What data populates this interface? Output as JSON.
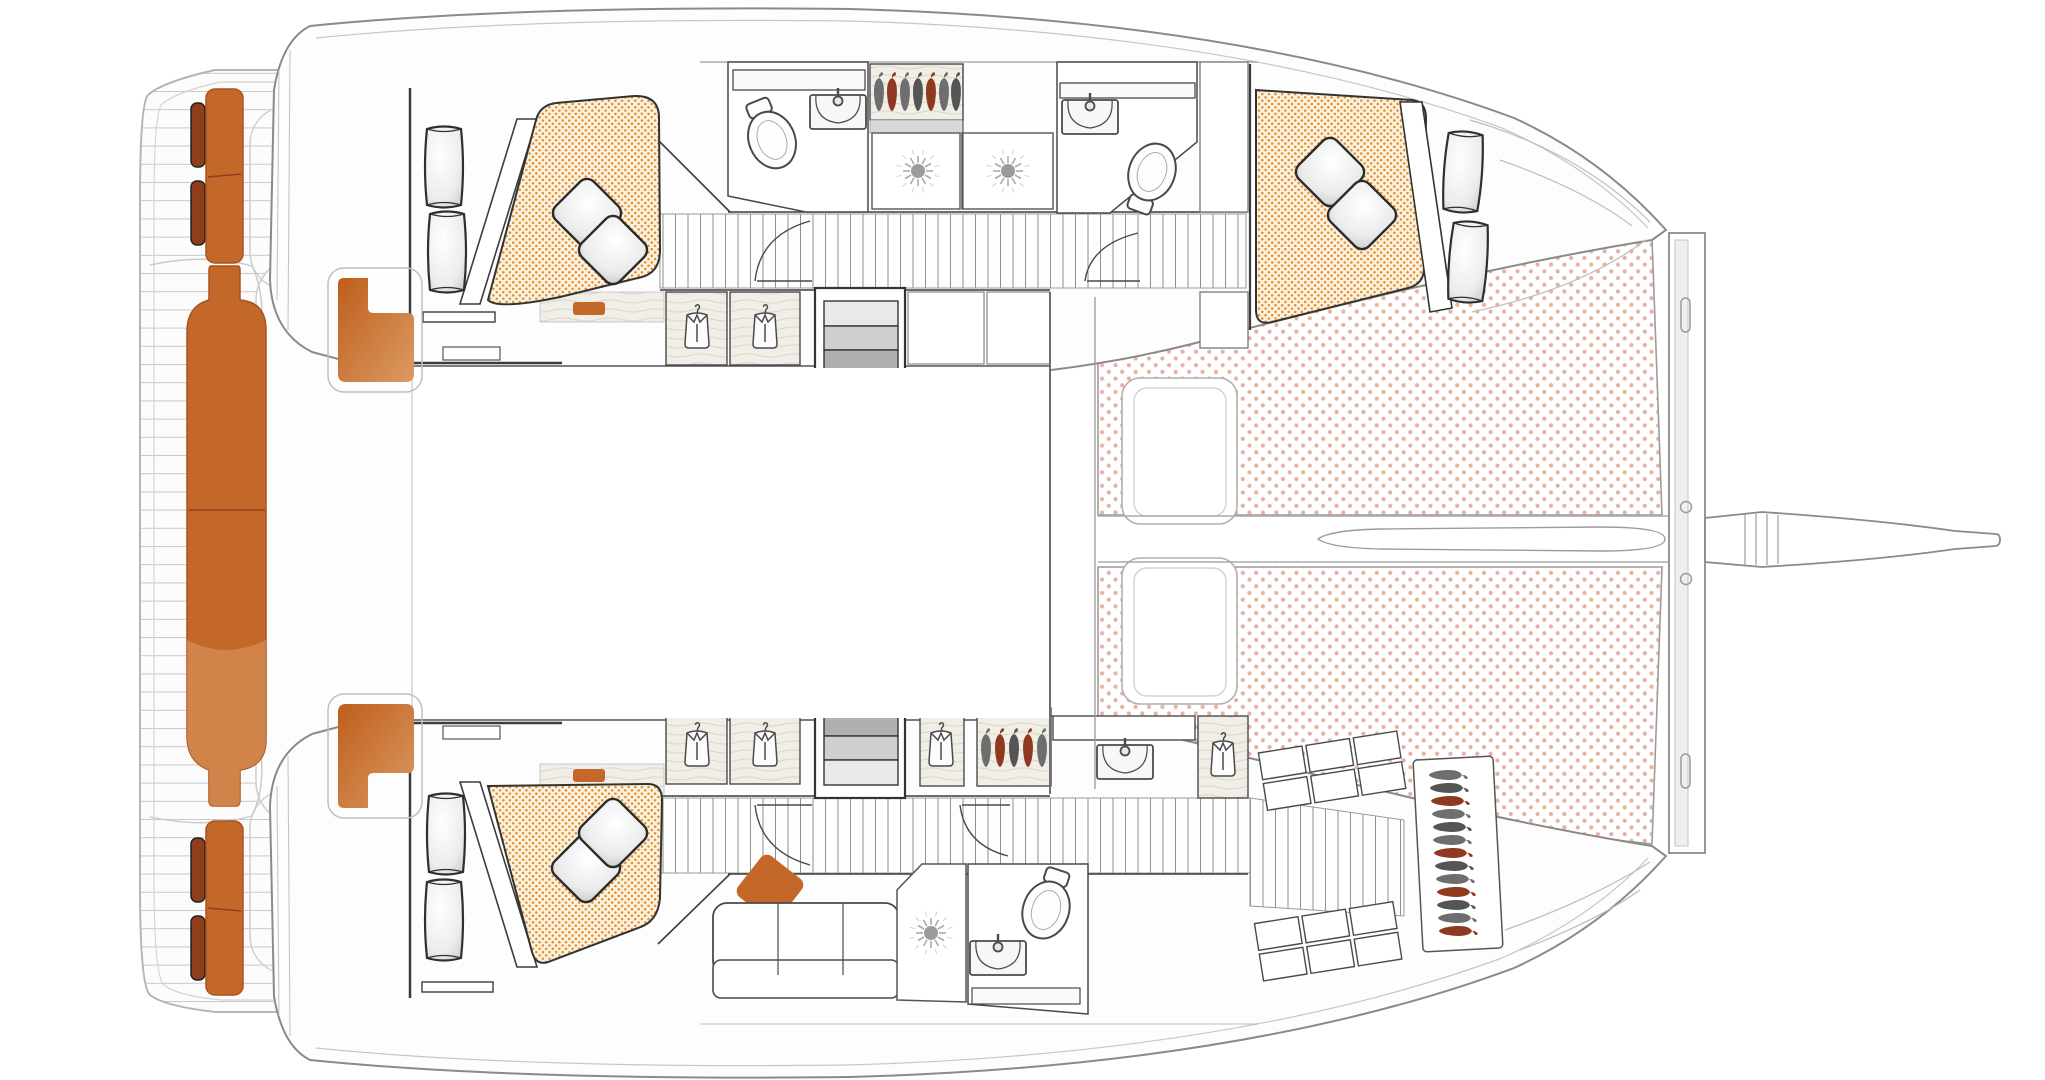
{
  "document": {
    "type": "deck-plan-diagram",
    "subject": "sailing-catamaran-top-view",
    "text_labels": []
  },
  "colors": {
    "background": "#ffffff",
    "accent_orange": "#C4682A",
    "accent_orange_deep": "#A9531D",
    "accent_orange_light": "#DC9A62",
    "cushion_dark": "#8F3E1C",
    "mattress_bg": "#FBF2DD",
    "mattress_dot": "#DF8A2E",
    "trampoline_dot": "#E5B2A0",
    "hull_line": "#8A8A8A",
    "hull_line_light": "#C6C6C6",
    "platform_line": "#C2C2C2",
    "wall_line": "#3C3C3C",
    "fixture_line": "#4A4A4A",
    "floor_plank_line": "#8F8F8F",
    "deck_plank_line": "#C9C9C9",
    "step_light": "#E9E9E9",
    "step_mid1": "#CFCFCF",
    "step_mid2": "#B0B0B0",
    "step_dark": "#8E8E8E",
    "hanger_red": "#8F3A20",
    "hanger_gray": "#6E6E6E",
    "pillow_stroke": "#2B2B2B",
    "wood_bg": "#F1EEE7",
    "wood_line": "#DCD6C9",
    "sun_gray": "#9B9B9B"
  },
  "inventory": {
    "hulls": 2,
    "trampolines": 2,
    "trampoline_pads": 2,
    "crossbeam": 1,
    "bowsprit": 1,
    "anchor_chute": 1,
    "double_berths": 3,
    "berth_pillows": 6,
    "berth_bolsters": 6,
    "bow_sunpad_bolsters": 2,
    "toilets": 3,
    "wash_basins": 4,
    "vanity_mirrors": 3,
    "shower_stalls_sunburst": 3,
    "shirt_wardrobes": 6,
    "hanger_lockers": 3,
    "companionway_stairs": 2,
    "cockpit_corner_seats": 2,
    "transom_seats": 2,
    "center_transom_bench": 1,
    "transom_bolsters": 4,
    "storage_shelf_cells": 12,
    "salon_sofa": 1,
    "sofa_accent_cushion": 1,
    "bed_steps": 2
  }
}
